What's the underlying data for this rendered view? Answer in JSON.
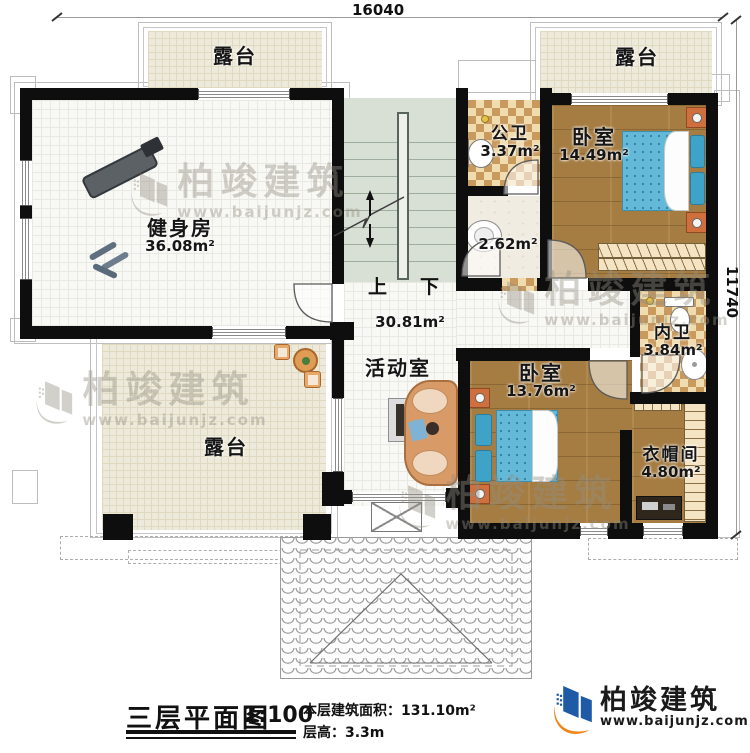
{
  "dimensions": {
    "top": "16040",
    "right": "11740"
  },
  "rooms": {
    "terrace_top_left": {
      "name": "露台"
    },
    "terrace_top_right": {
      "name": "露台"
    },
    "terrace_bottom_left": {
      "name": "露台"
    },
    "gym": {
      "name": "健身房",
      "area": "36.08m²"
    },
    "public_bath": {
      "name": "公卫",
      "area": "3.37m²"
    },
    "washroom": {
      "area": "2.62m²"
    },
    "bedroom_top": {
      "name": "卧室",
      "area": "14.49m²"
    },
    "inner_bath": {
      "name": "内卫",
      "area": "3.84m²"
    },
    "activity": {
      "name": "活动室",
      "area": "30.81m²"
    },
    "bedroom_bottom": {
      "name": "卧室",
      "area": "13.76m²"
    },
    "cloakroom": {
      "name": "衣帽间",
      "area": "4.80m²"
    }
  },
  "stairs": {
    "up": "上",
    "down": "下"
  },
  "title_block": {
    "title": "三层平面图",
    "scale": "1:100",
    "floor_area_label": "本层建筑面积：",
    "floor_area_value": "131.10m²",
    "floor_height_label": "层高：",
    "floor_height_value": "3.3m"
  },
  "brand": {
    "name": "柏竣建筑",
    "website": "www.baijunjz.com"
  },
  "watermark": {
    "name": "柏竣建筑",
    "website": "www.baijunjz.com"
  },
  "colors": {
    "wall": "#0e0e0e",
    "wood": "#a57c42",
    "bed": "#64b9d8",
    "brand_blue": "#1e5aa6",
    "brand_orange": "#f08619"
  }
}
